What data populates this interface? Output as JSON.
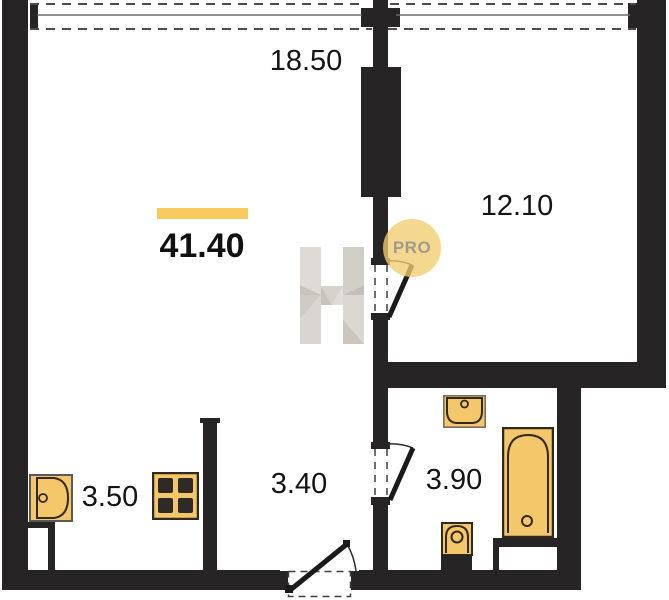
{
  "plan": {
    "total_area": "41.40",
    "rooms": [
      {
        "name": "living-room",
        "area": "18.50"
      },
      {
        "name": "bedroom",
        "area": "12.10"
      },
      {
        "name": "kitchen",
        "area": "3.50"
      },
      {
        "name": "hallway",
        "area": "3.40"
      },
      {
        "name": "bathroom",
        "area": "3.90"
      }
    ],
    "watermark_letter": "H",
    "badge_text": "PRO",
    "colors": {
      "wall": "#262424",
      "fixture_fill": "#f4c86a",
      "fixture_outline": "#33291a",
      "accent_bar": "#f8ca5f",
      "badge_fill": "#f2cd70",
      "badge_text_color": "#a29b8d",
      "watermark_gray": "#d6d2cc",
      "floor": "#ffffff"
    }
  }
}
